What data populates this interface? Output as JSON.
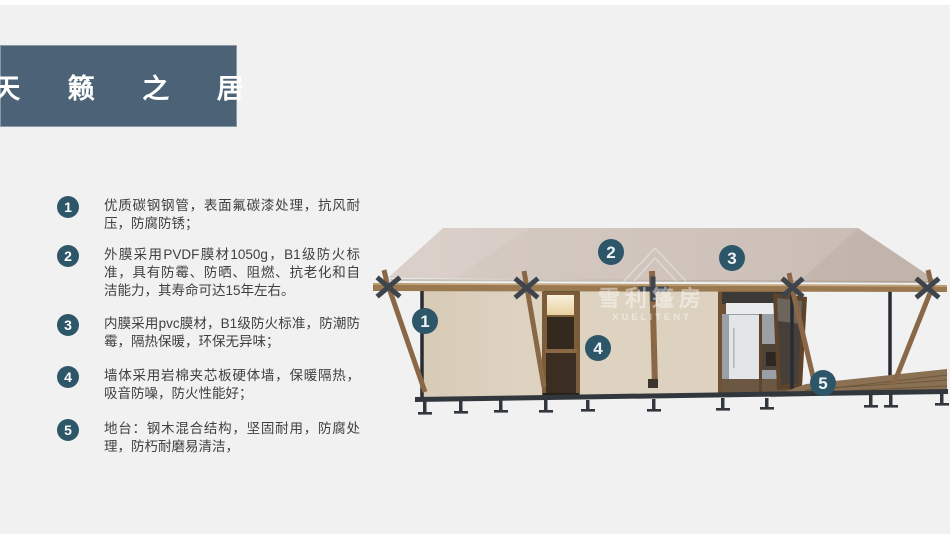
{
  "colors": {
    "background": "#f1f1f2",
    "header_bg": "#4c6377",
    "badge": "#2d5769",
    "body_text": "#3f3f3f",
    "roof": "#cfc3bb",
    "wall": "#ddd2c0",
    "wood": "#8a6847",
    "steel": "#31373d"
  },
  "header": {
    "title": "天 籁 之 居"
  },
  "features": [
    {
      "num": "1",
      "text": "优质碳钢钢管，表面氟碳漆处理，抗风耐压，防腐防锈；"
    },
    {
      "num": "2",
      "text": "外膜采用PVDF膜材1050g，B1级防火标准，具有防霉、防晒、阻燃、抗老化和自洁能力，其寿命可达15年左右。"
    },
    {
      "num": "3",
      "text": "内膜采用pvc膜材，B1级防火标准，防潮防霉，隔热保暖，环保无异味；"
    },
    {
      "num": "4",
      "text": "墙体采用岩棉夹芯板硬体墙，保暖隔热，吸音防噪，防火性能好；"
    },
    {
      "num": "5",
      "text": "地台：钢木混合结构，坚固耐用，防腐处理，防朽耐磨易清洁，"
    }
  ],
  "diagram": {
    "watermark": {
      "cn": "雪利篷房",
      "en": "XUELITENT"
    },
    "badges": [
      {
        "num": "1"
      },
      {
        "num": "2"
      },
      {
        "num": "3"
      },
      {
        "num": "4"
      },
      {
        "num": "5"
      }
    ]
  }
}
